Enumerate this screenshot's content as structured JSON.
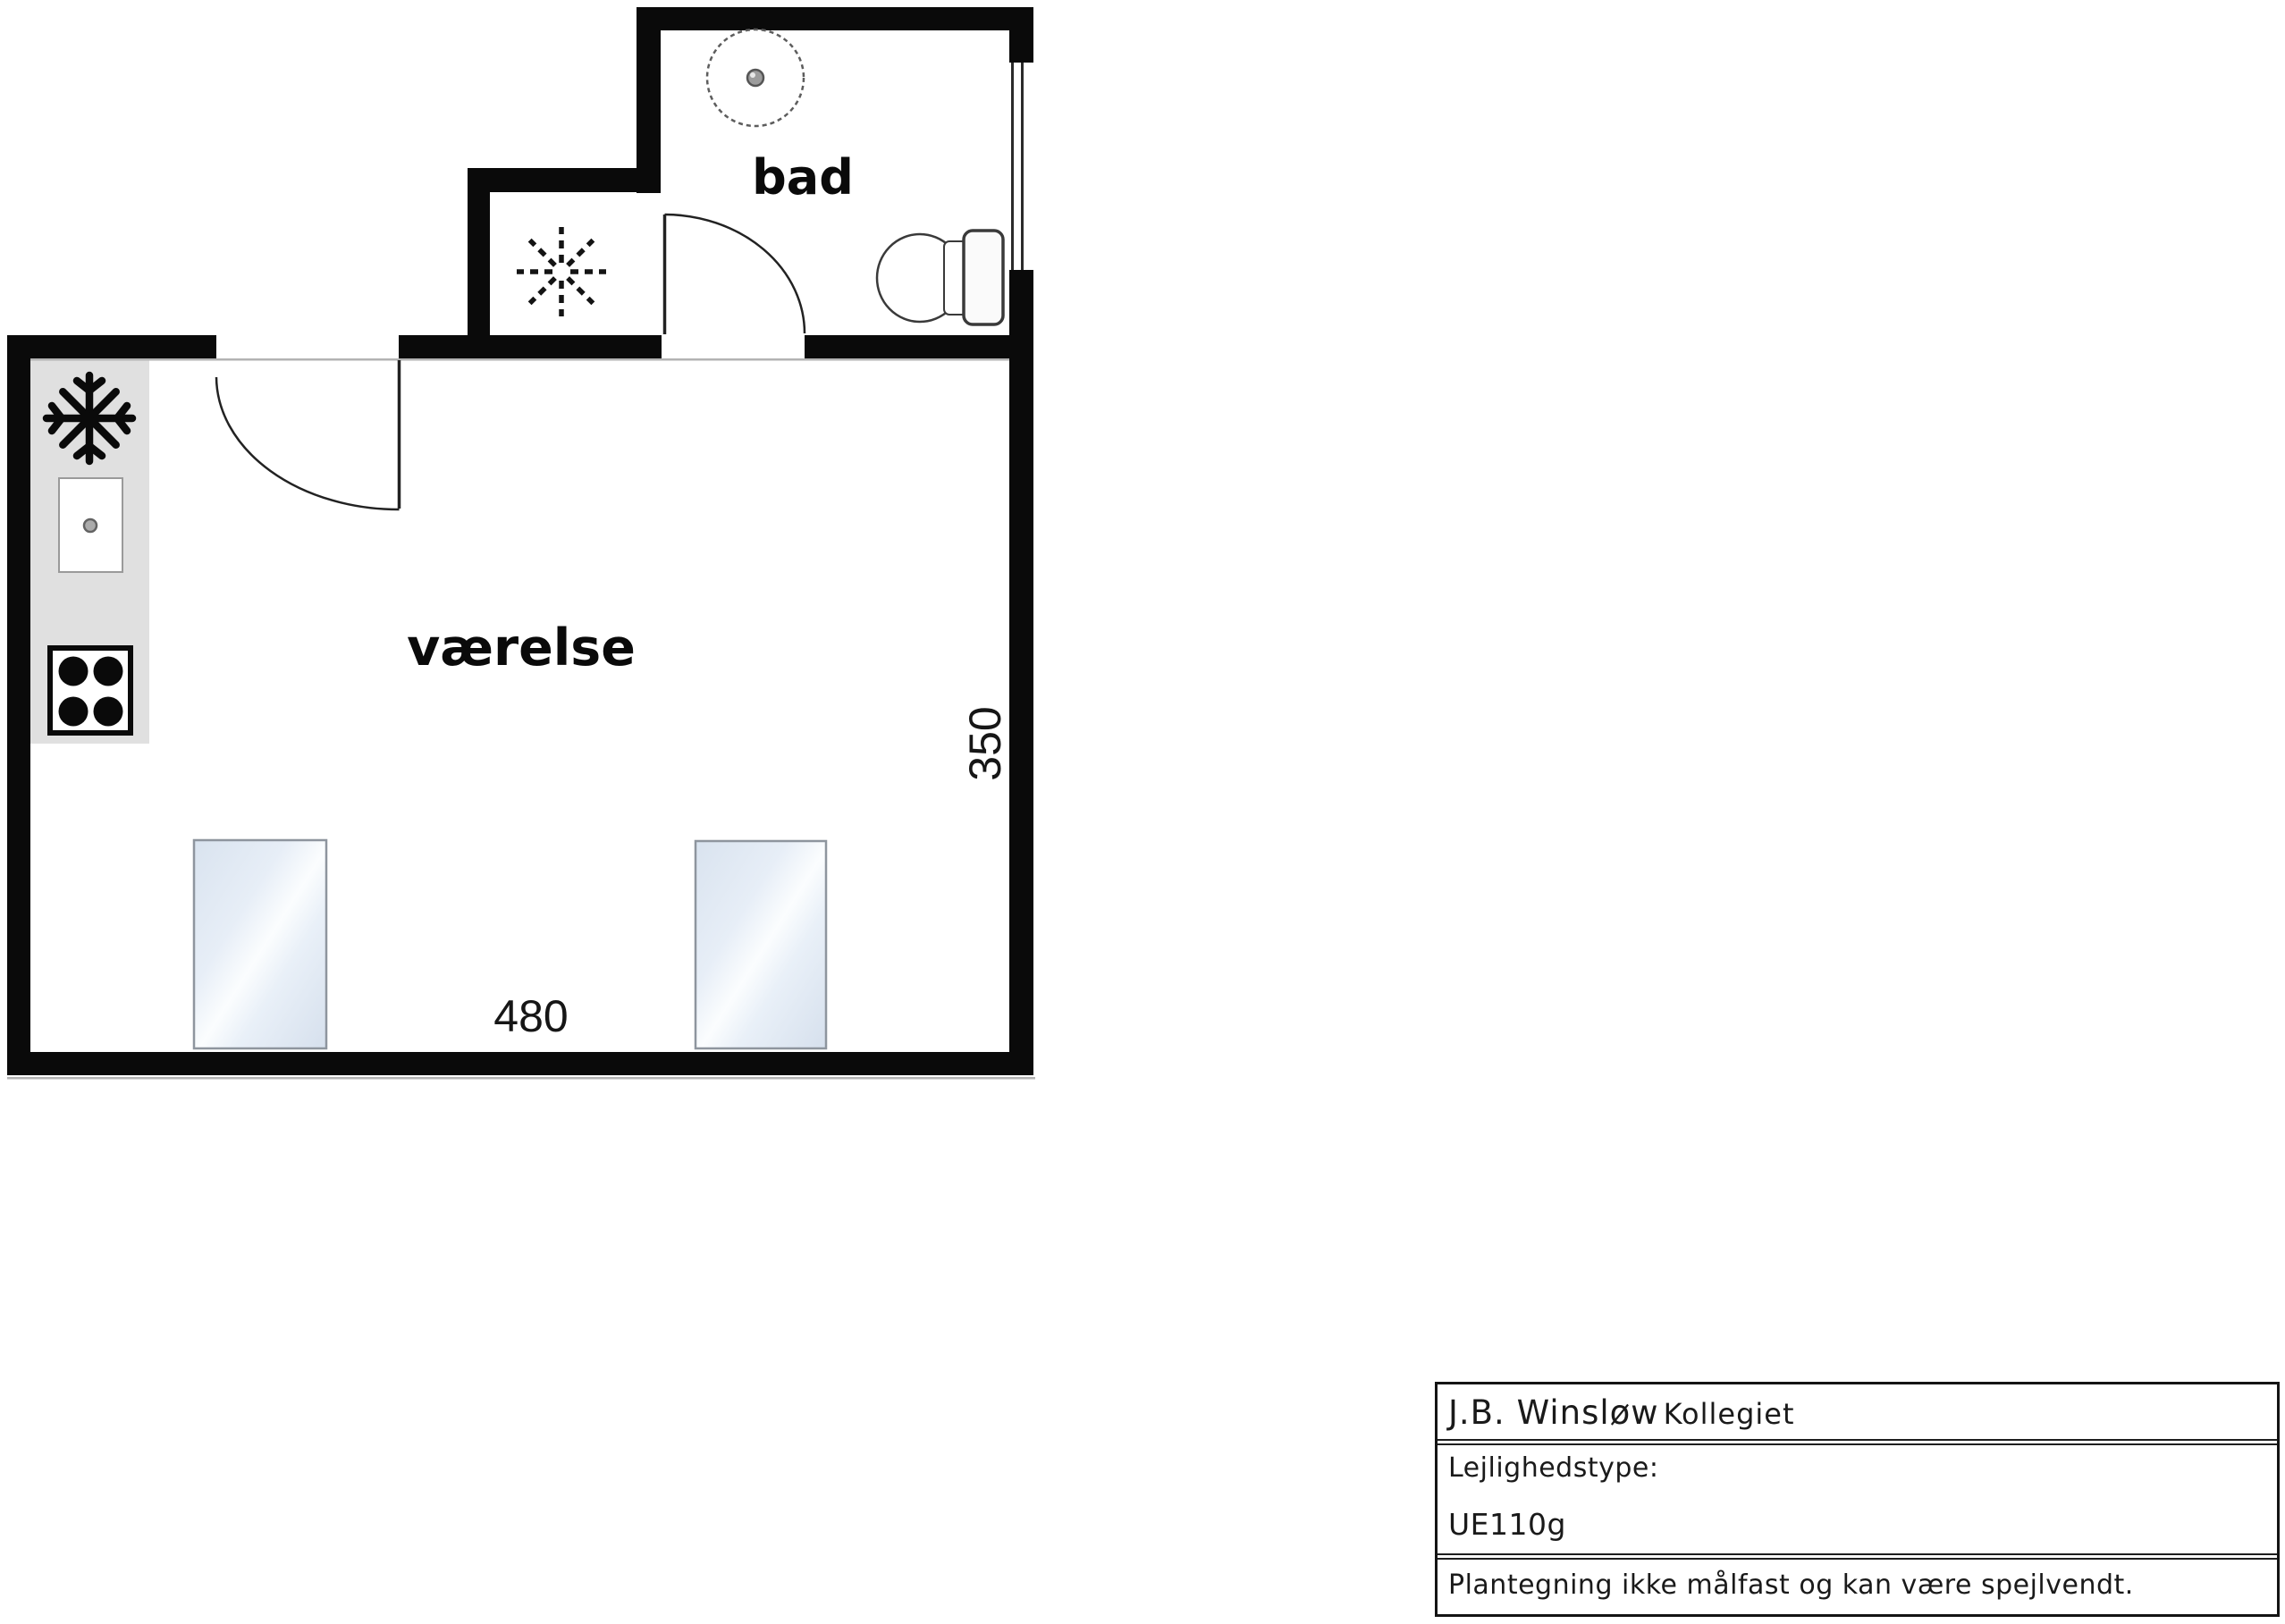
{
  "floor_plan": {
    "main_room_label": "værelse",
    "bathroom_label": "bad",
    "width_dimension": "480",
    "depth_dimension": "350",
    "symbols": {
      "freezer": "snowflake-icon",
      "sink": "sink-with-drain-symbol",
      "stove": "four-burner-stove-symbol",
      "ventilation": "dashed-fan-star-icon",
      "shower": "floor-drain-dashed-circle",
      "toilet": "toilet-with-cistern-symbol",
      "windows": "glass-panel",
      "doors": "quarter-arc-door-swing"
    },
    "colors": {
      "walls": "#0a0a0a",
      "kitchen_counter": "#e0e0e0",
      "glass_tint": "#dce6f1",
      "hairline": "#b3b3b3"
    }
  },
  "title_block": {
    "name_primary": "J.B. Winsløw",
    "name_secondary": "Kollegiet",
    "type_label": "Lejlighedstype:",
    "type_value": "UE110g",
    "disclaimer": "Plantegning ikke målfast og kan være spejlvendt."
  }
}
